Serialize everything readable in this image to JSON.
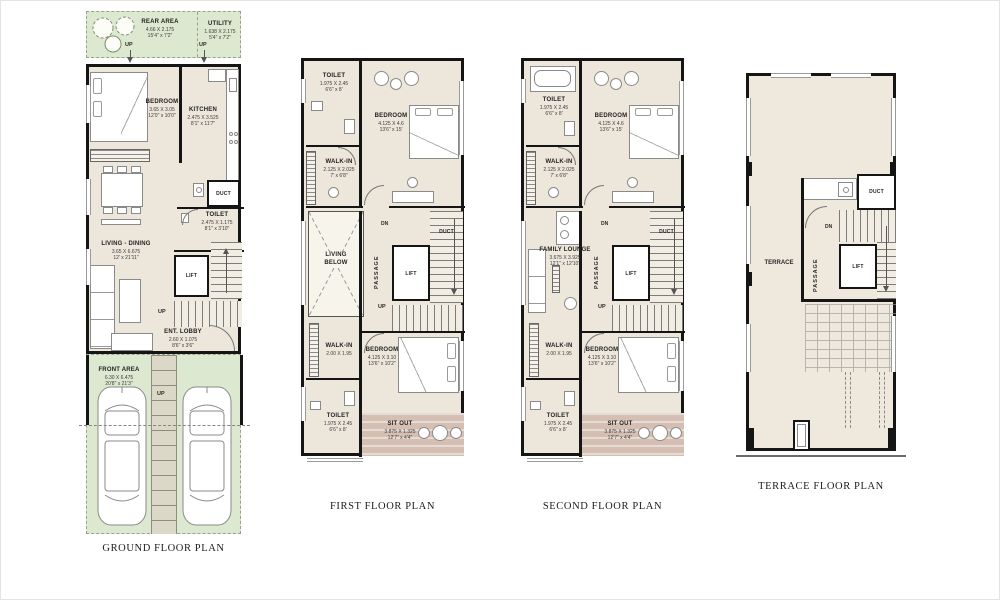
{
  "labels": {
    "up": "UP",
    "dn": "DN"
  },
  "colors": {
    "floor": "#ece6db",
    "green_area": "#dce8d0",
    "sit_out": "#d4bfb2",
    "wall": "#151515"
  },
  "plans": {
    "ground": {
      "title": "GROUND FLOOR PLAN",
      "rooms": {
        "rear_area": {
          "name": "REAR AREA",
          "dim_m": "4.66 X 2.175",
          "dim_ft": "15'4\" x 7'2\""
        },
        "utility": {
          "name": "UTILITY",
          "dim_m": "1.638 X 2.175",
          "dim_ft": "5'4\" x 7'2\""
        },
        "bedroom": {
          "name": "BEDROOM",
          "dim_m": "3.65 X 3.05",
          "dim_ft": "12'0\" x 10'0\""
        },
        "kitchen": {
          "name": "KITCHEN",
          "dim_m": "2.475 X 3.525",
          "dim_ft": "8'1\" x 11'7\""
        },
        "living_dining": {
          "name": "LIVING - DINING",
          "dim_m": "3.65 X 6.675",
          "dim_ft": "12' x 21'11\""
        },
        "toilet": {
          "name": "TOILET",
          "dim_m": "2.475 X 1.175",
          "dim_ft": "8'1\" x 3'10\""
        },
        "duct": {
          "name": "DUCT"
        },
        "lift": {
          "name": "LIFT"
        },
        "ent_lobby": {
          "name": "ENT. LOBBY",
          "dim_m": "2.60 X 1.075",
          "dim_ft": "8'6\" x 3'6\""
        },
        "front_area": {
          "name": "FRONT AREA",
          "dim_m": "6.30 X 6.475",
          "dim_ft": "20'8\" x 21'3\""
        }
      }
    },
    "first": {
      "title": "FIRST FLOOR PLAN",
      "rooms": {
        "toilet_top": {
          "name": "TOILET",
          "dim_m": "1.975 X 2.45",
          "dim_ft": "6'6\" x 8'"
        },
        "bedroom_top": {
          "name": "BEDROOM",
          "dim_m": "4.125 X 4.6",
          "dim_ft": "13'6\" x 15'"
        },
        "walkin_top": {
          "name": "WALK-IN",
          "dim_m": "2.125 X 2.025",
          "dim_ft": "7' x 6'8\""
        },
        "duct": {
          "name": "DUCT"
        },
        "living_below": {
          "name": "LIVING BELOW"
        },
        "passage": {
          "name": "PASSAGE"
        },
        "lift": {
          "name": "LIFT"
        },
        "walkin_bottom": {
          "name": "WALK-IN",
          "dim_m": "2.00 X 1.95"
        },
        "bedroom_bottom": {
          "name": "BEDROOM",
          "dim_m": "4.125 X 3.10",
          "dim_ft": "13'6\" x 10'2\""
        },
        "toilet_bottom": {
          "name": "TOILET",
          "dim_m": "1.975 X 2.45",
          "dim_ft": "6'6\" x 8'"
        },
        "sit_out": {
          "name": "SIT OUT",
          "dim_m": "3.875 X 1.325",
          "dim_ft": "12'7\" x 4'4\""
        }
      }
    },
    "second": {
      "title": "SECOND FLOOR PLAN",
      "rooms": {
        "toilet_top": {
          "name": "TOILET",
          "dim_m": "1.975 X 2.45",
          "dim_ft": "6'6\" x 8'"
        },
        "bedroom_top": {
          "name": "BEDROOM",
          "dim_m": "4.125 X 4.6",
          "dim_ft": "13'6\" x 15'"
        },
        "walkin_top": {
          "name": "WALK-IN",
          "dim_m": "2.125 X 2.025",
          "dim_ft": "7' x 6'8\""
        },
        "duct": {
          "name": "DUCT"
        },
        "family_lounge": {
          "name": "FAMILY LOUNGE",
          "dim_m": "3.675 X 3.925",
          "dim_ft": "12'1\" x 12'10\""
        },
        "passage": {
          "name": "PASSAGE"
        },
        "lift": {
          "name": "LIFT"
        },
        "walkin_bottom": {
          "name": "WALK-IN",
          "dim_m": "2.00 X 1.95"
        },
        "bedroom_bottom": {
          "name": "BEDROOM",
          "dim_m": "4.125 X 3.10",
          "dim_ft": "13'6\" x 10'2\""
        },
        "toilet_bottom": {
          "name": "TOILET",
          "dim_m": "1.975 X 2.45",
          "dim_ft": "6'6\" x 8'"
        },
        "sit_out": {
          "name": "SIT OUT",
          "dim_m": "3.875 X 1.325",
          "dim_ft": "12'7\" x 4'4\""
        }
      }
    },
    "terrace": {
      "title": "TERRACE FLOOR PLAN",
      "rooms": {
        "terrace": {
          "name": "TERRACE"
        },
        "passage": {
          "name": "PASSAGE"
        },
        "lift": {
          "name": "LIFT"
        },
        "duct": {
          "name": "DUCT"
        }
      }
    }
  }
}
